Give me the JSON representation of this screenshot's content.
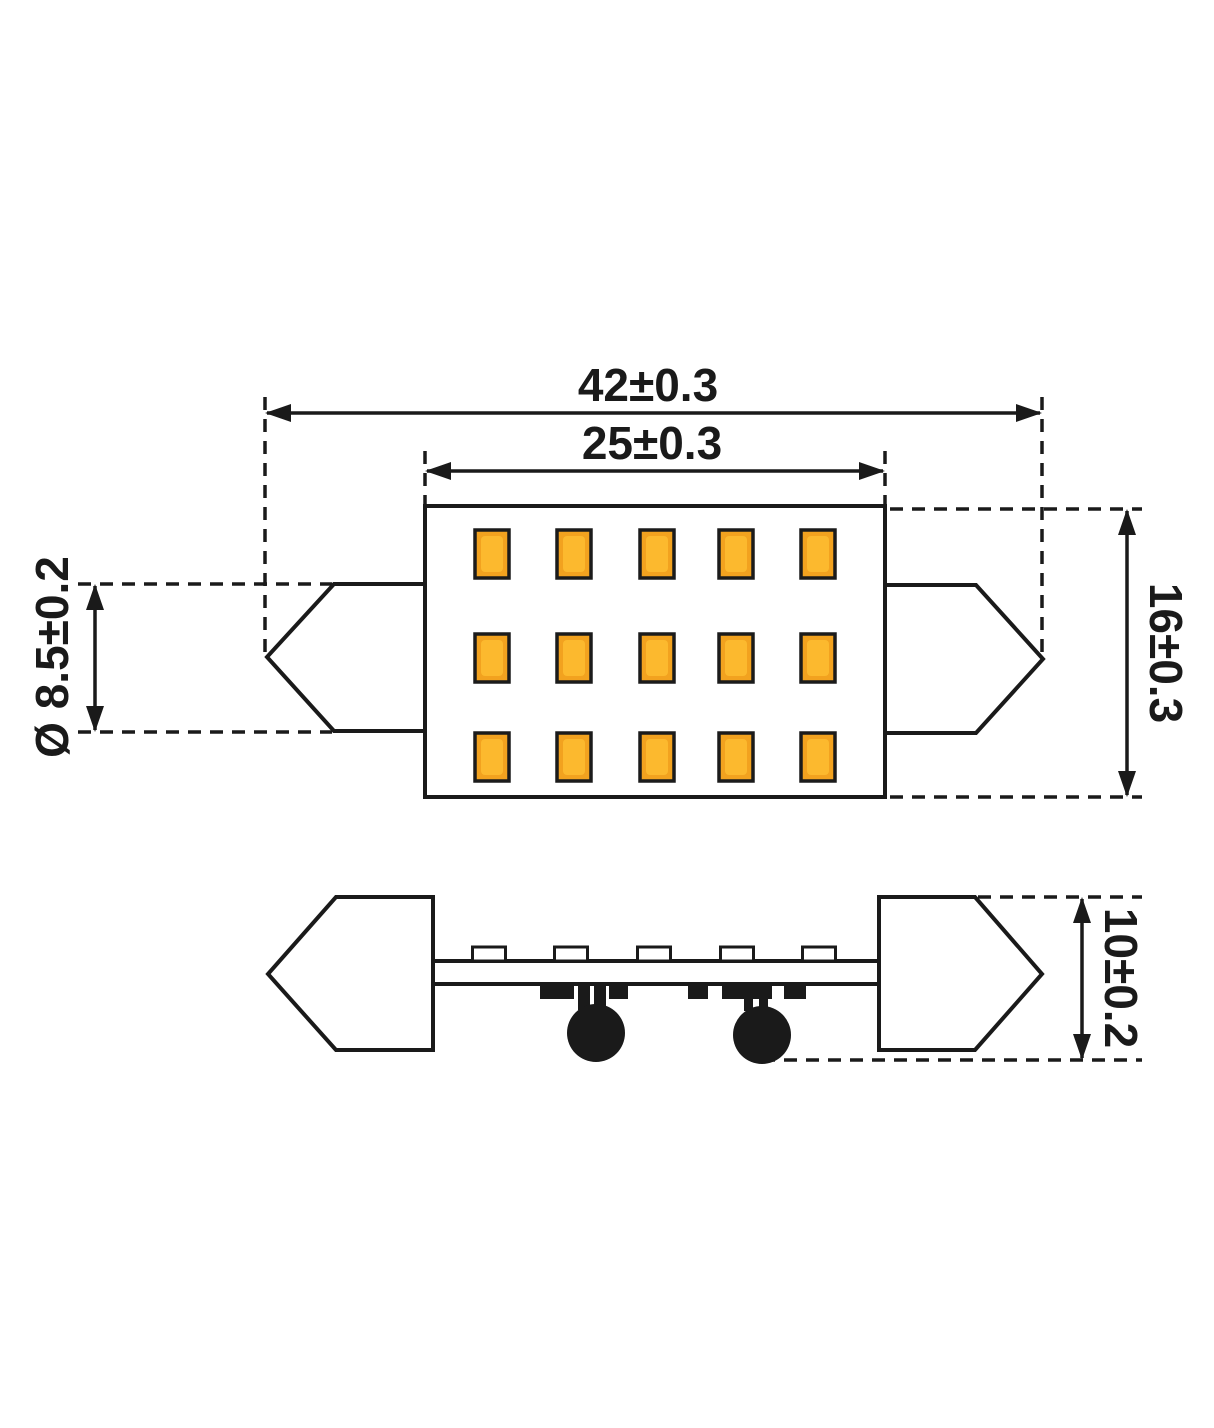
{
  "drawing": {
    "background_color": "#ffffff",
    "line_color": "#1a1a1a",
    "dimensions": {
      "overall_length": {
        "label": "42±0.3"
      },
      "body_length": {
        "label": "25±0.3"
      },
      "tip_diameter": {
        "label": "Ø 8.5±0.2"
      },
      "body_height": {
        "label": "16±0.3"
      },
      "side_height": {
        "label": "10±0.2"
      }
    },
    "top_view": {
      "led_grid": {
        "rows": 3,
        "cols": 5,
        "count": 15,
        "fill": "#F2A21F",
        "inner_fill": "#FCB92E",
        "border": "#1b1b1b"
      }
    },
    "side_view": {
      "led_profile_count": 5,
      "capacitor_count": 2,
      "component_color": "#111111"
    }
  }
}
